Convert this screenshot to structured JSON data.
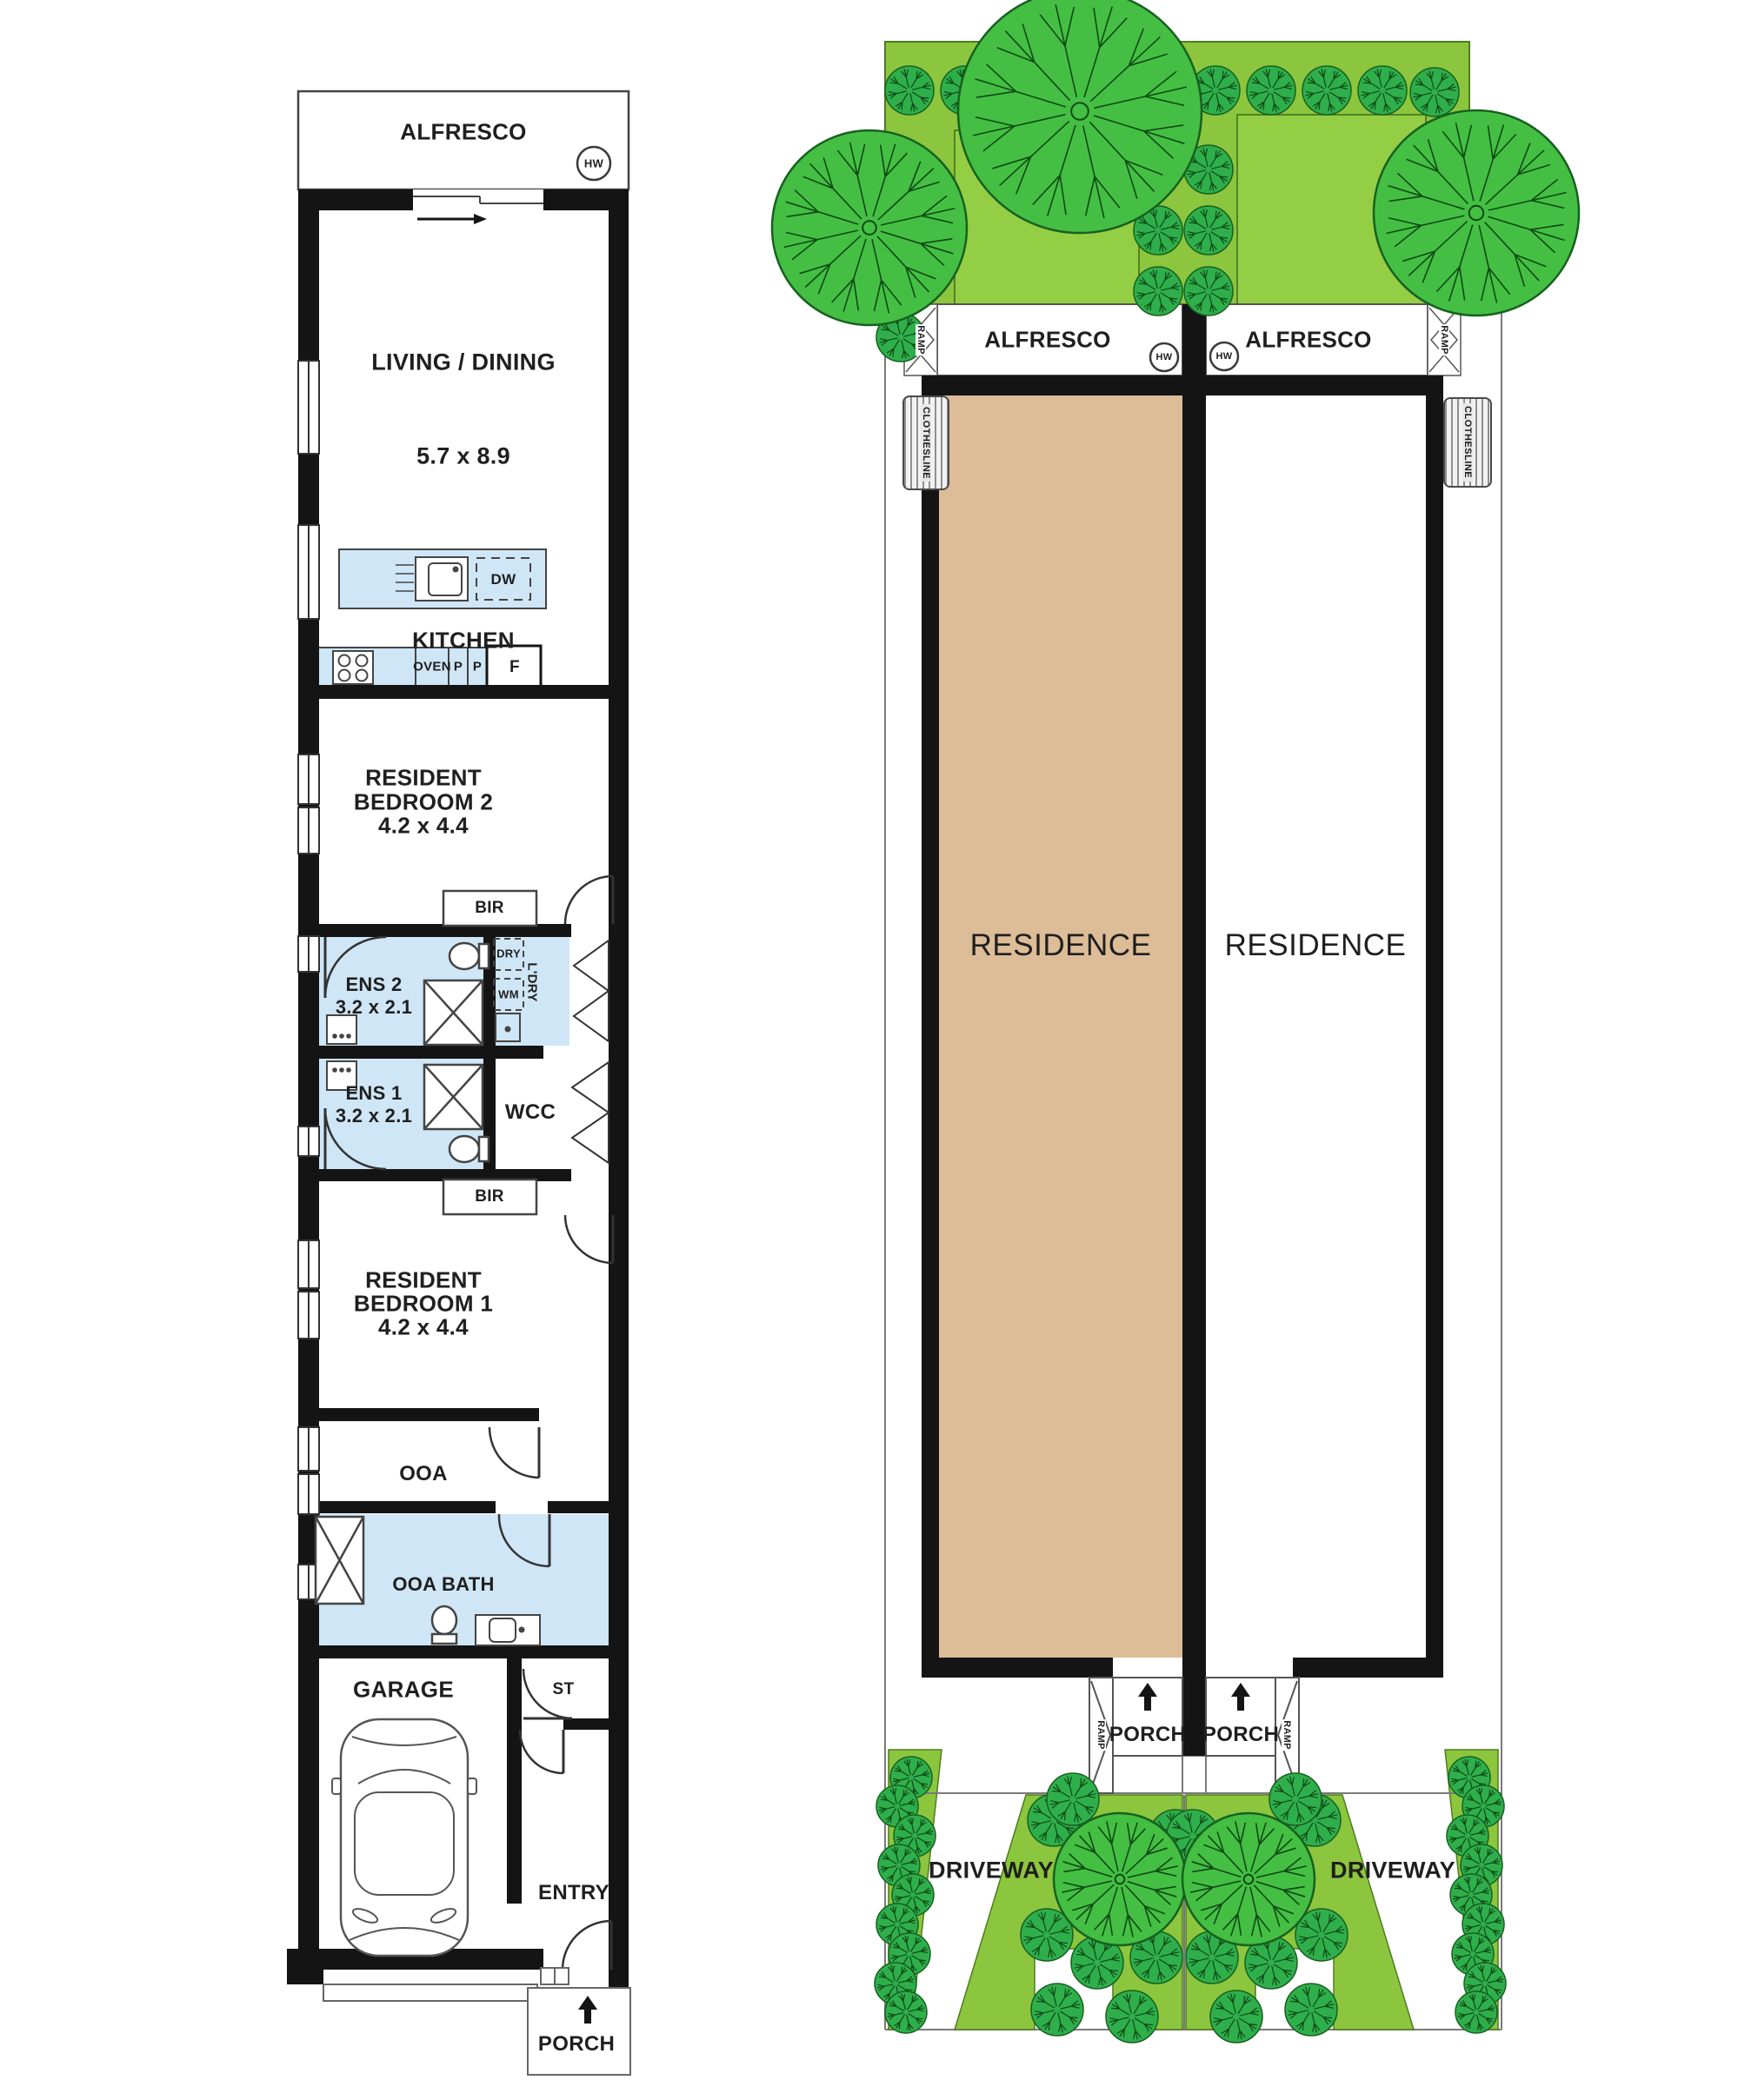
{
  "left_plan": {
    "alfresco": "ALFRESCO",
    "hw": "HW",
    "living_name": "LIVING / DINING",
    "living_dims": "5.7 x 8.9",
    "kitchen": "KITCHEN",
    "dw": "DW",
    "oven": "OVEN",
    "pantry1": "P",
    "pantry2": "P",
    "fridge": "F",
    "bed2_line1": "RESIDENT",
    "bed2_line2": "BEDROOM 2",
    "bed2_dims": "4.2 x 4.4",
    "bed2_bir": "BIR",
    "dry": "DRY",
    "wm": "WM",
    "laundry": "L'DRY",
    "ens2_name": "ENS 2",
    "ens2_dims": "3.2 x 2.1",
    "ens1_name": "ENS 1",
    "ens1_dims": "3.2 x 2.1",
    "wcc": "WCC",
    "bed1_bir": "BIR",
    "bed1_line1": "RESIDENT",
    "bed1_line2": "BEDROOM 1",
    "bed1_dims": "4.2 x 4.4",
    "ooa": "OOA",
    "ooa_bath": "OOA BATH",
    "garage": "GARAGE",
    "st": "ST",
    "entry": "ENTRY",
    "porch": "PORCH"
  },
  "site_plan": {
    "alfresco_left": "ALFRESCO",
    "alfresco_right": "ALFRESCO",
    "hw_left": "HW",
    "hw_right": "HW",
    "ramp_top_left": "RAMP",
    "ramp_top_right": "RAMP",
    "clothesline_left": "CLOTHESLINE",
    "clothesline_right": "CLOTHESLINE",
    "residence_left": "RESIDENCE",
    "residence_right": "RESIDENCE",
    "porch_left": "PORCH",
    "porch_right": "PORCH",
    "ramp_bottom_left": "RAMP",
    "ramp_bottom_right": "RAMP",
    "driveway_left": "DRIVEWAY",
    "driveway_right": "DRIVEWAY"
  },
  "colors": {
    "wall": "#141414",
    "wet_area": "#cfe6f6",
    "residence_fill": "#ddbc98",
    "lawn": "#8cc63e",
    "shrub": "#2fae4c",
    "tree": "#44bf44",
    "outline": "#4a4a4a"
  }
}
